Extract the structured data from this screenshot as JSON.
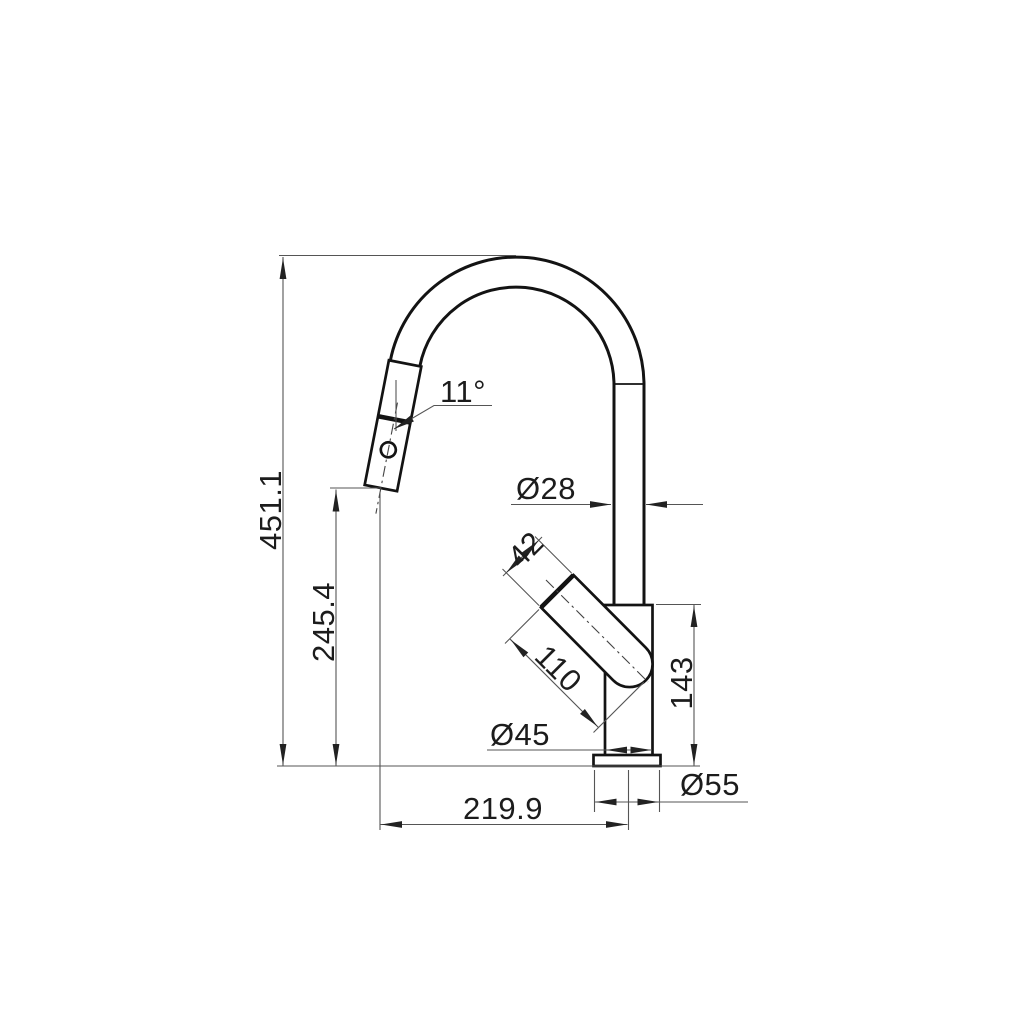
{
  "drawing": {
    "kind": "technical-dimension-drawing",
    "subject": "pull-down kitchen faucet, side elevation",
    "background_color": "#ffffff",
    "outline_color": "#131313",
    "dimension_line_color": "#555555",
    "text_color": "#1c1c1c",
    "arrow_style": "filled-triangle",
    "dimensions": {
      "total_height": "451.1",
      "spout_outlet_height": "245.4",
      "spray_head_angle": "11°",
      "spout_tube_diameter": "Ø28",
      "handle_diameter": "42",
      "handle_length": "110",
      "body_diameter": "Ø45",
      "body_height": "143",
      "base_diameter": "Ø55",
      "spout_reach": "219.9"
    }
  }
}
